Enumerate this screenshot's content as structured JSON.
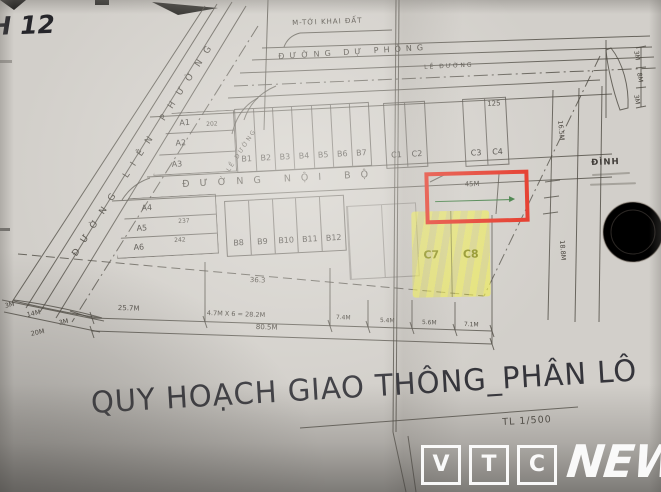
{
  "photo": {
    "corner_note": "H 12",
    "top_note": "M-TỚI KHAI ĐẤT",
    "dinh_note": "ĐÌNH",
    "title": "QUY HOẠCH GIAO THÔNG_PHÂN LÔ",
    "scale": "TL 1/500"
  },
  "roads": {
    "lien_phuong": "ĐƯỜNG LIÊN PHƯỜNG",
    "du_phong": "ĐƯỜNG DỰ PHÒNG",
    "noi_bo": "ĐƯỜNG NỘI BỘ",
    "shoulder_top": "LỀ ĐƯỜNG",
    "shoulder_left": "LỀ ĐƯỜNG"
  },
  "lots": {
    "row1_a": [
      "A1",
      "A2",
      "A3"
    ],
    "row1_b": [
      "B1",
      "B2",
      "B3",
      "B4",
      "B5",
      "B6",
      "B7"
    ],
    "row1_c12": [
      "C1",
      "C2"
    ],
    "row1_c34": [
      "C3",
      "C4"
    ],
    "row2_a": [
      "A4",
      "A5",
      "A6"
    ],
    "row2_b": [
      "B8",
      "B9",
      "B10",
      "B11",
      "B12"
    ],
    "highlight": [
      "C7",
      "C8"
    ]
  },
  "numbers": {
    "a1_area": "202",
    "a4_area": "237",
    "a5_area": "242",
    "road_top": "125",
    "row2_width": "36.3",
    "red_box_dim": "45M"
  },
  "dimensions": {
    "bottom_chain": [
      "25.7M",
      "4.7M X 6 = 28.2M",
      "7.4M",
      "5.4M",
      "5.6M",
      "7.1M"
    ],
    "bottom_total": "80.5M",
    "left_road": [
      "3M",
      "14M",
      "3M"
    ],
    "left_road_total": "20M",
    "right_arrow": [
      "3M",
      "8M",
      "3M"
    ],
    "right_side": [
      "16.5M",
      "18.8M"
    ]
  },
  "colors": {
    "highlight_red": "#e53020",
    "highlight_yellow": "#e9e83a",
    "ink": "#4a463f"
  },
  "logo": {
    "letters": [
      "V",
      "T",
      "C"
    ],
    "word": "NEWS"
  }
}
